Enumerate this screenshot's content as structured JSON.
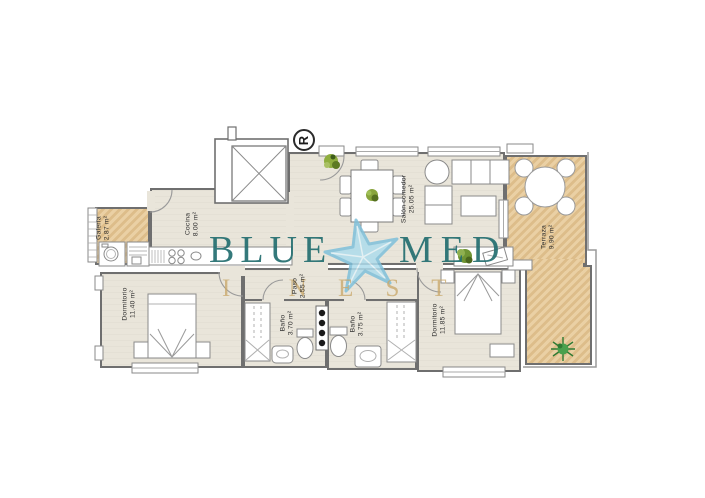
{
  "brand": {
    "word1": "BLUE",
    "word2": "MED",
    "sub_left": "I N",
    "sub_right": "E S T",
    "starfish_icon": "starfish",
    "teal_color": "#236e70",
    "sand_color": "#c9a86b",
    "starfish_color": "#aedcec"
  },
  "plan_marker": {
    "label": "R"
  },
  "rooms": [
    {
      "name": "Galería",
      "area": "2.87 m²"
    },
    {
      "name": "Cocina",
      "area": "8.00 m²"
    },
    {
      "name": "Salón comedor",
      "area": "25.05 m²"
    },
    {
      "name": "Terraza",
      "area": "9.90 m²"
    },
    {
      "name": "Dormitorio",
      "area": "11.40 m²"
    },
    {
      "name": "Paso",
      "area": "2.55 m²"
    },
    {
      "name": "Baño",
      "area": "3.70 m²"
    },
    {
      "name": "Baño",
      "area": "3.75 m²"
    },
    {
      "name": "Dormitorio",
      "area": "11.85 m²"
    }
  ],
  "colors": {
    "floor": "#e9e5da",
    "wood": "#e2c598",
    "wall": "#6f6f6f"
  }
}
